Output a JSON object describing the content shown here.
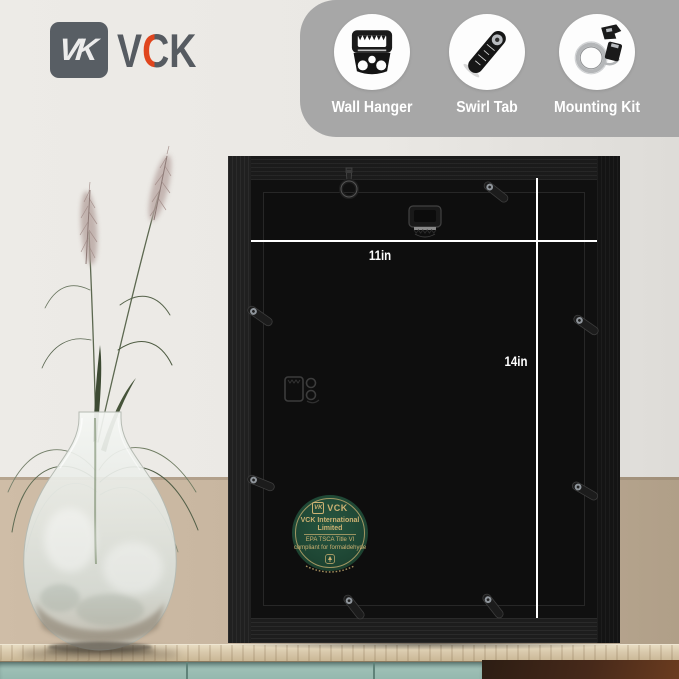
{
  "brand": {
    "name": "VCK",
    "monogram": "VK",
    "letters": [
      "V",
      "C",
      "K"
    ],
    "accent_color": "#e0451d",
    "logo_color": "#565b61"
  },
  "features": {
    "band_color": "#a7a7a7",
    "items": [
      {
        "label": "Wall Hanger",
        "icon": "wall-hanger-icon"
      },
      {
        "label": "Swirl Tab",
        "icon": "swirl-tab-icon"
      },
      {
        "label": "Mounting Kit",
        "icon": "mounting-kit-icon"
      }
    ]
  },
  "frame_back": {
    "width_label": "11in",
    "height_label": "14in",
    "frame_color": "#181818",
    "hardware": [
      "d-ring-hanger",
      "sawtooth-hanger",
      "side-sawtooth-hanger",
      "swirl-tabs"
    ]
  },
  "sticker": {
    "brand": "VCK",
    "title": "VCK International Limited",
    "line1": "EPA TSCA Title VI",
    "line2": "compliant for formaldehyde",
    "bg_color": "#1e4634",
    "text_color": "#cdb273"
  },
  "scene": {
    "wall_top_color": "#eae8e4",
    "wall_bottom_color": "#c4b29c",
    "cabinet_color": "#95b8ae",
    "table_color": "#d9c9ac"
  }
}
